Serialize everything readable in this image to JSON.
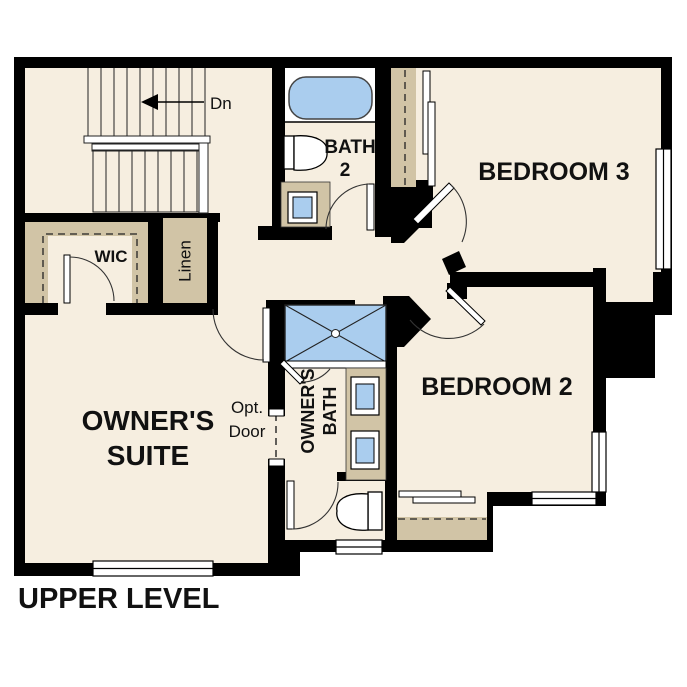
{
  "plan": {
    "title": "UPPER LEVEL",
    "labels": {
      "owners_suite_line1": "OWNER'S",
      "owners_suite_line2": "SUITE",
      "bedroom2": "BEDROOM 2",
      "bedroom3": "BEDROOM 3",
      "bath2_line1": "BATH",
      "bath2_line2": "2",
      "owners_bath_line1": "OWNER'S",
      "owners_bath_line2": "BATH",
      "wic": "WIC",
      "linen": "Linen",
      "stairs_direction": "Dn",
      "opt_door_line1": "Opt.",
      "opt_door_line2": "Door"
    },
    "colors": {
      "wall": "#000000",
      "floor": "#f6eee0",
      "closet_tan": "#d1c4a6",
      "fixture_blue": "#aacdee",
      "outline": "#333333"
    }
  }
}
